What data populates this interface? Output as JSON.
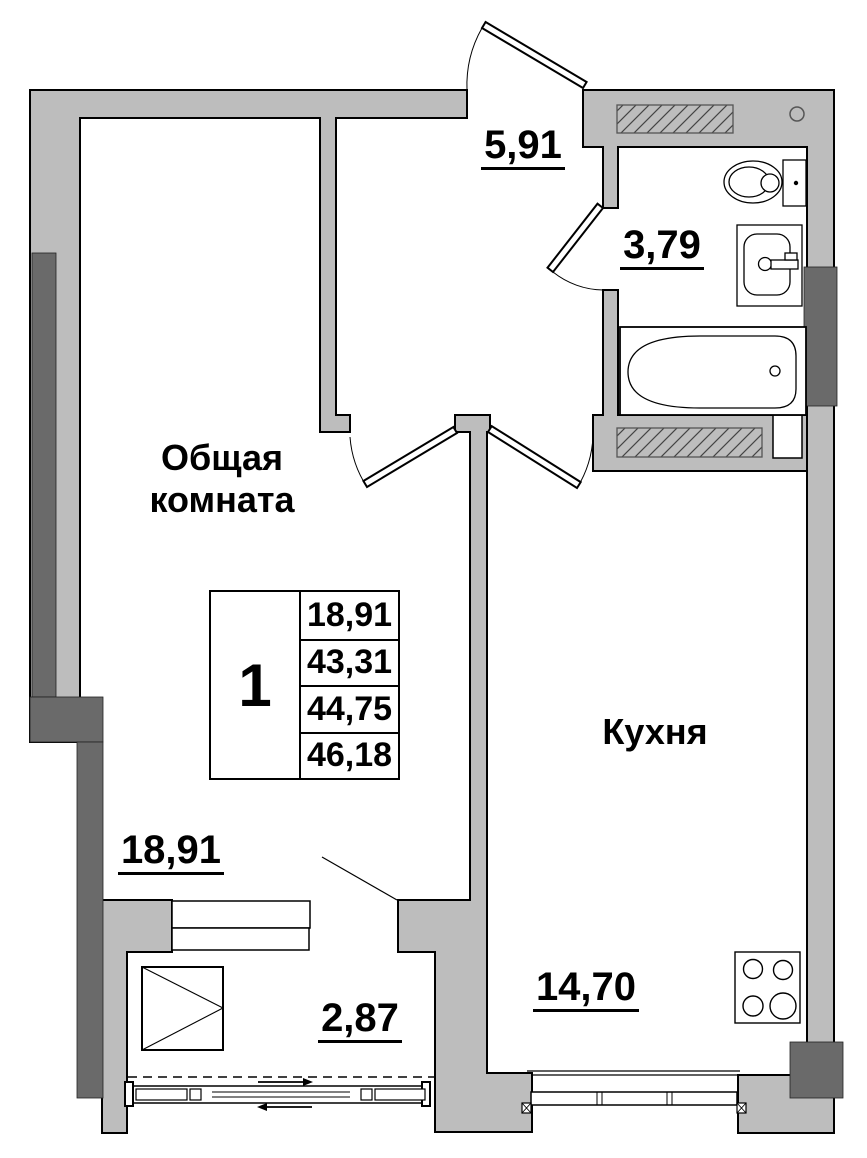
{
  "rooms": {
    "living_room": {
      "name": "Общая комната",
      "area": "18,91"
    },
    "kitchen": {
      "name": "Кухня",
      "area": "14,70"
    },
    "hallway": {
      "area": "5,91"
    },
    "bathroom": {
      "area": "3,79"
    },
    "balcony": {
      "area": "2,87"
    }
  },
  "summary_table": {
    "rooms_count": "1",
    "rows": [
      "18,91",
      "43,31",
      "44,75",
      "46,18"
    ]
  },
  "colors": {
    "wall": "#bdbdbd",
    "wall_accent_dark": "#6a6a6a",
    "line": "#000000"
  }
}
